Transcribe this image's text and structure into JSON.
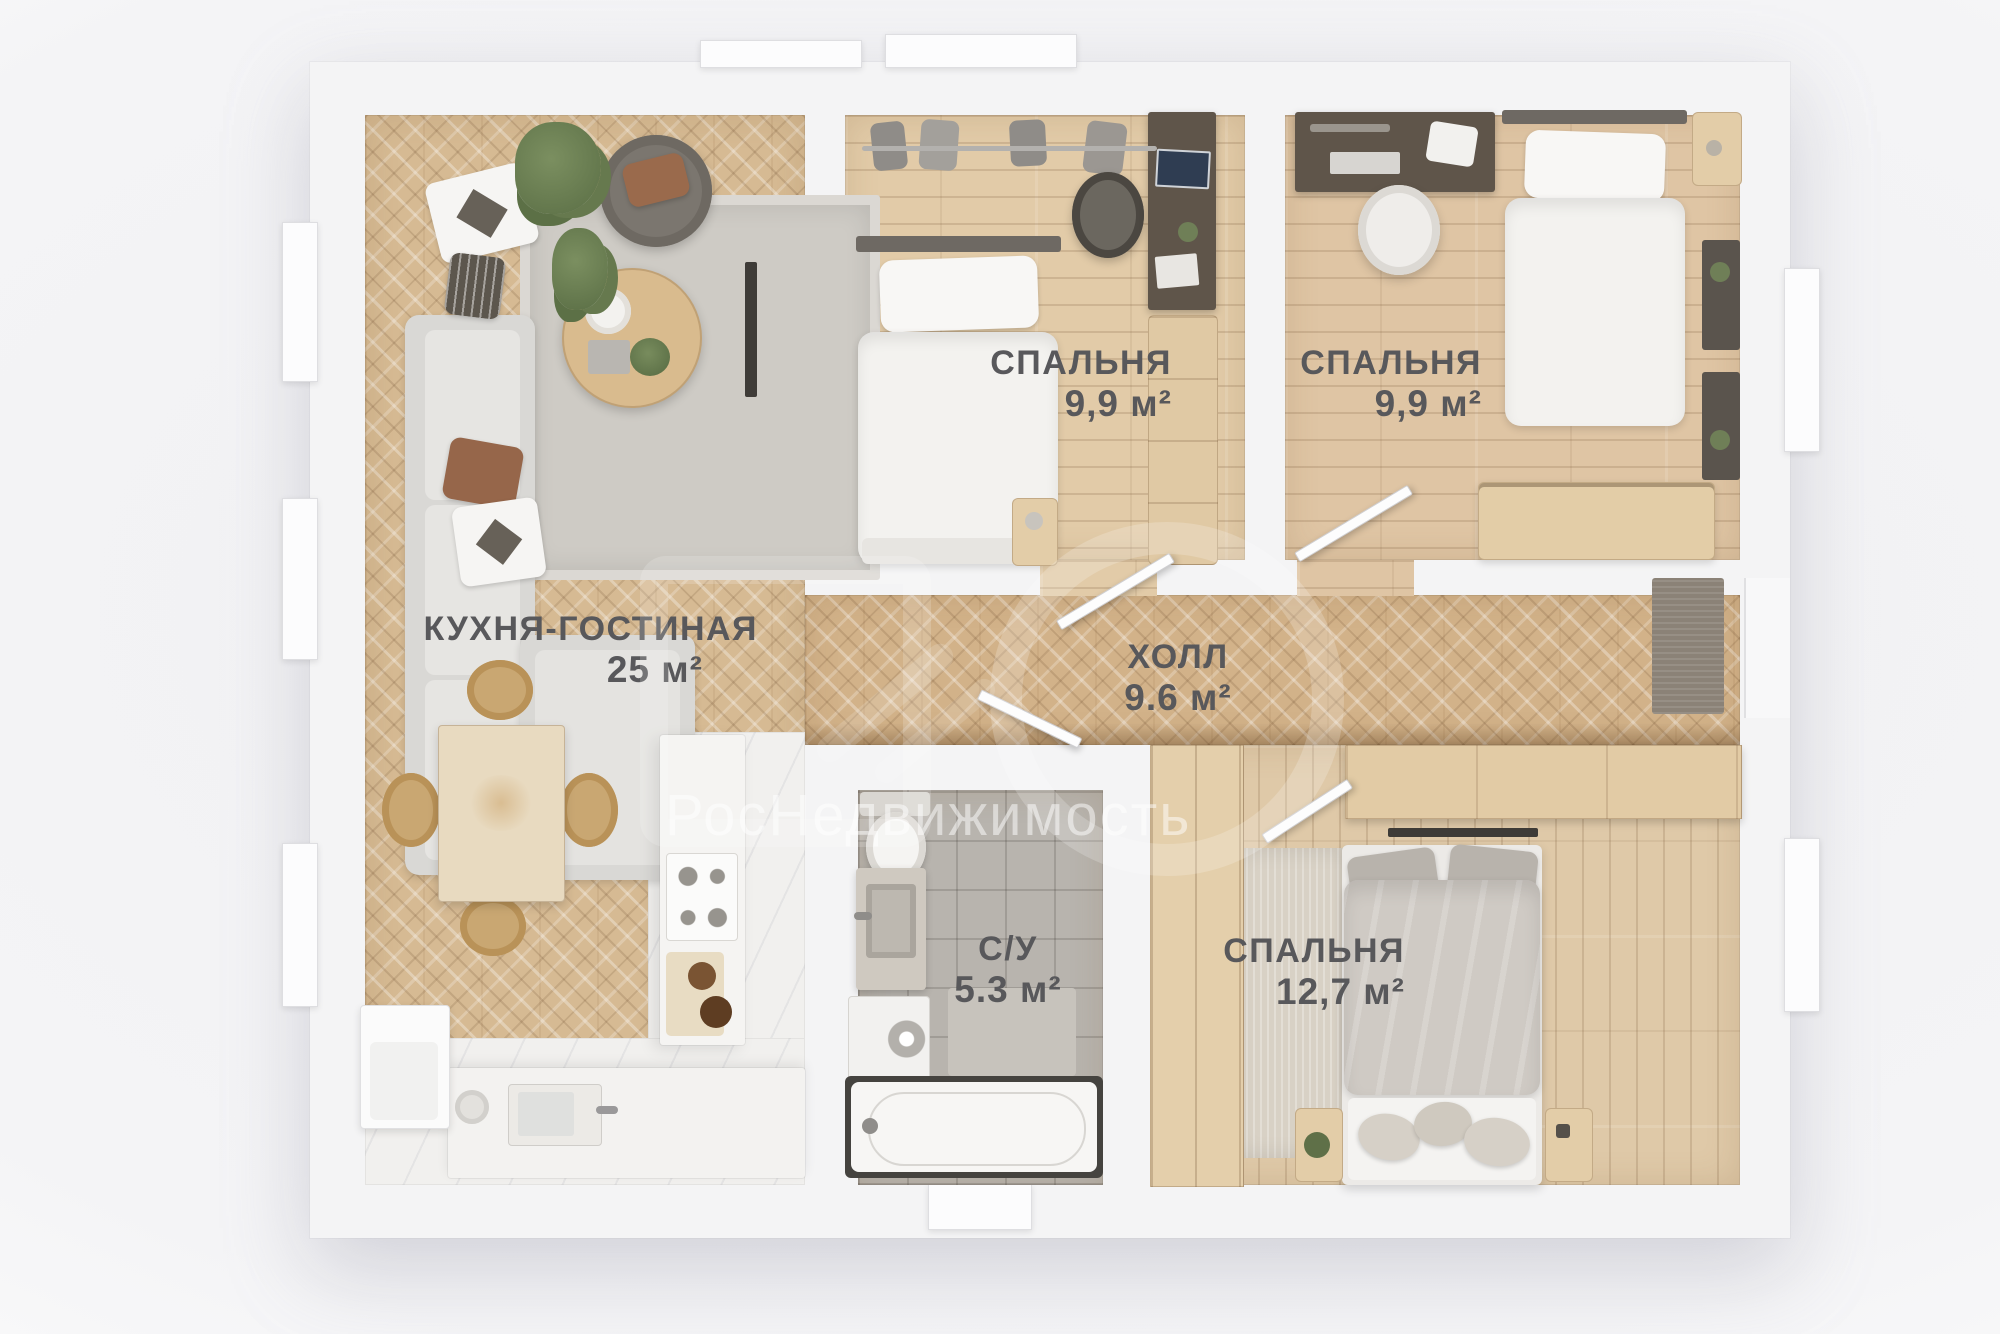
{
  "watermark": {
    "brand": "РосНедвижимость"
  },
  "rooms": {
    "kitchen_living": {
      "name": "КУХНЯ-ГОСТИНАЯ",
      "area": "25 м²"
    },
    "bedroom_top_middle": {
      "name": "СПАЛЬНЯ",
      "area": "9,9 м²"
    },
    "bedroom_top_right": {
      "name": "СПАЛЬНЯ",
      "area": "9,9 м²"
    },
    "hall": {
      "name": "ХОЛЛ",
      "area": "9.6 м²"
    },
    "bathroom": {
      "name": "С/У",
      "area": "5.3 м²"
    },
    "bedroom_bottom_right": {
      "name": "СПАЛЬНЯ",
      "area": "12,7 м²"
    }
  },
  "colors": {
    "wall": "#f4f4f5",
    "herringbone_floor": "#d6ba93",
    "plank_floor": "#e2cba8",
    "tile_floor": "#b8b4ae",
    "label_text": "#58585b",
    "watermark": "#ffffff"
  }
}
